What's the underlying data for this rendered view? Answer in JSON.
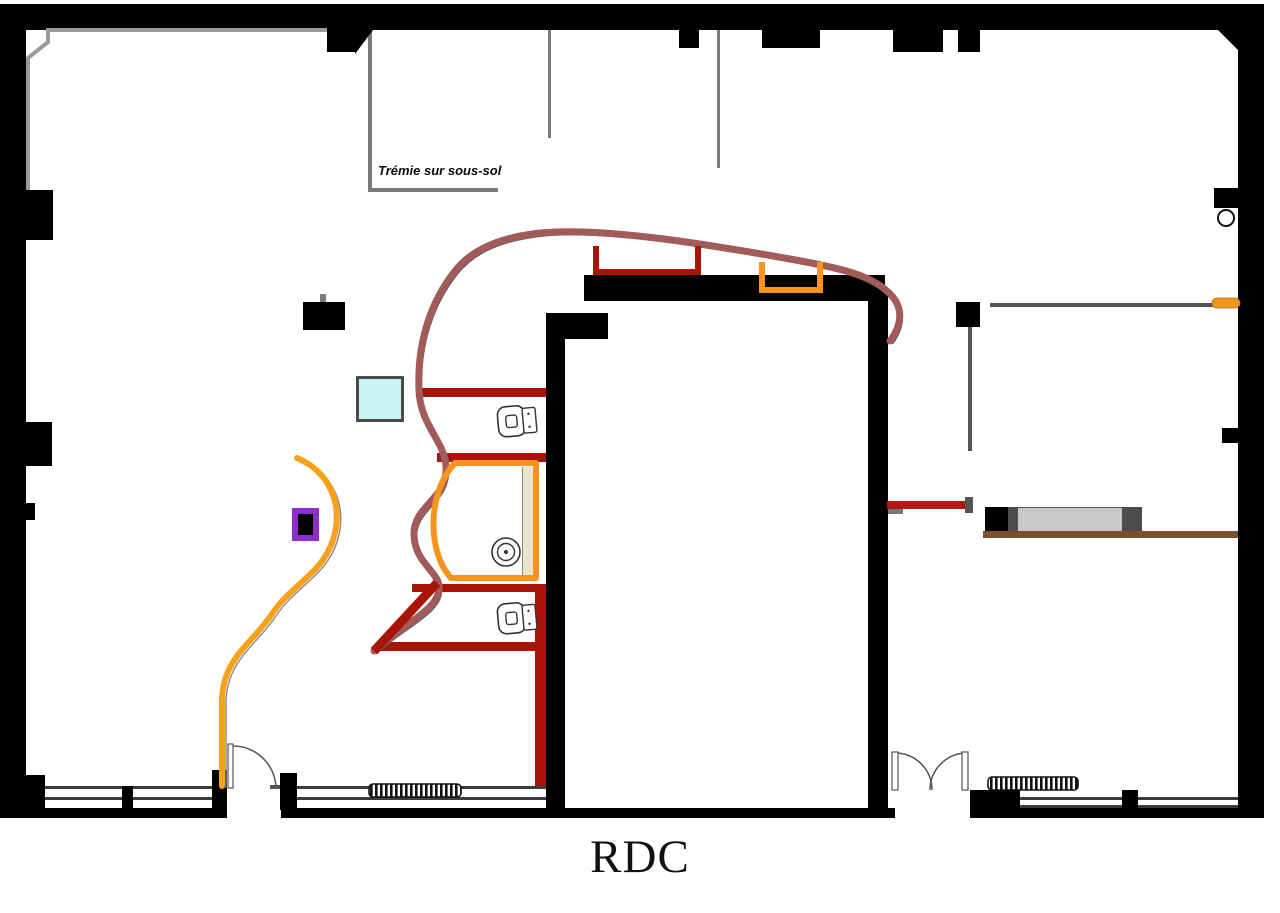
{
  "title": "RDC",
  "annotations": {
    "tremie": "Trémie sur sous-sol"
  },
  "palette": {
    "wall_black": "#000000",
    "partition_dark_red": "#a81408",
    "accent_orange": "#f7941d",
    "curve_maroon": "#a25b5b",
    "accent_purple": "#8b2fc9",
    "accent_cyan": "#c9f4f6",
    "counter_brown": "#7a4f2b",
    "furniture_gray": "#c8c8c8",
    "line_gray": "#777777",
    "trim_gray": "#999999"
  },
  "fixtures": {
    "toilet_count": 2,
    "sink_count": 1,
    "radiator_count": 2,
    "single_door_count": 1,
    "double_door_count": 1,
    "sideboard_count": 1
  }
}
